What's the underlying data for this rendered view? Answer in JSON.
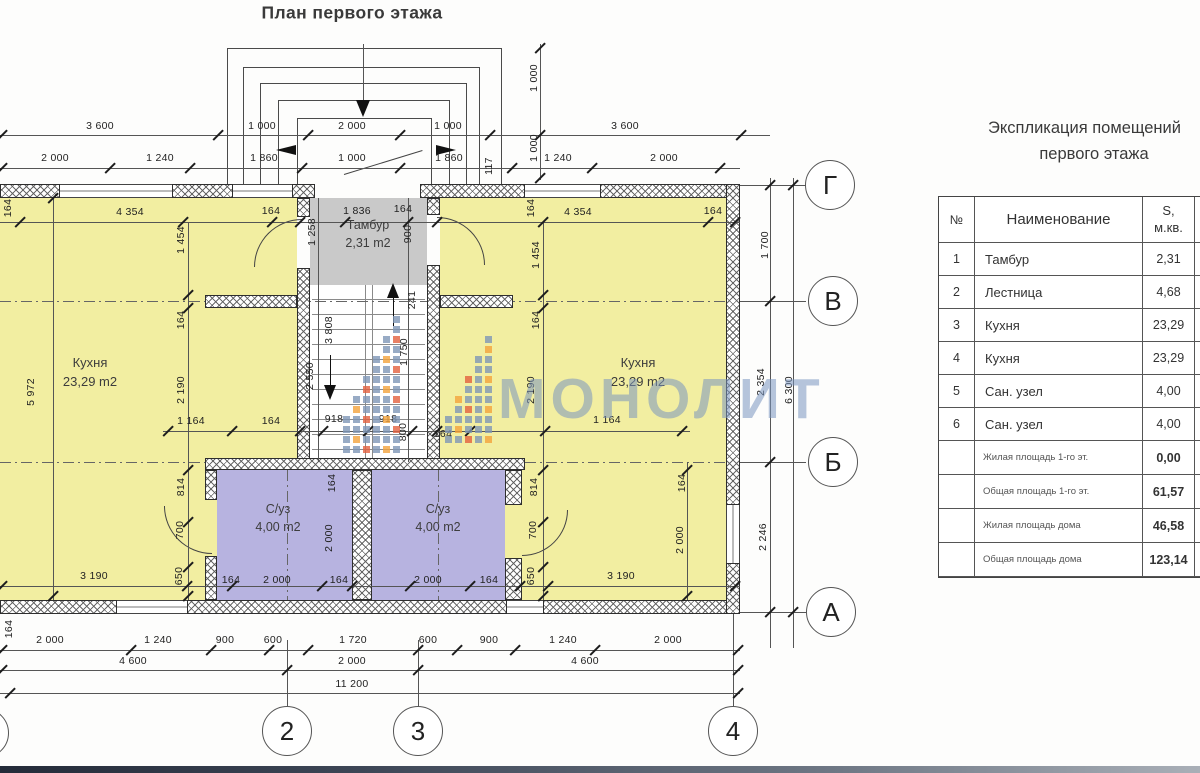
{
  "page": {
    "title": "План первого этажа"
  },
  "watermark": {
    "text": "МОНОЛИТ",
    "text_color": "#7a96c0",
    "logo_colors": {
      "slate": "#7e96b6",
      "orange": "#f2a33c",
      "red": "#e2603e"
    }
  },
  "plan": {
    "colors": {
      "kitchen": "#f2eea1",
      "bath": "#b7b3e0",
      "tambour": "#c9c9c9"
    },
    "rooms": {
      "kitchen_left": {
        "name": "Кухня",
        "area": "23,29 m2"
      },
      "kitchen_right": {
        "name": "Кухня",
        "area": "23,29 m2"
      },
      "tambour": {
        "name": "Тамбур",
        "area": "2,31 m2"
      },
      "bath_left": {
        "name": "С/уз",
        "area": "4,00 m2"
      },
      "bath_right": {
        "name": "С/уз",
        "area": "4,00 m2"
      }
    },
    "dims": [
      [
        "3 600",
        100,
        126,
        0
      ],
      [
        "1 000",
        262,
        126,
        0
      ],
      [
        "2 000",
        352,
        126,
        0
      ],
      [
        "1 000",
        448,
        126,
        0
      ],
      [
        "3 600",
        625,
        126,
        0
      ],
      [
        "2 000",
        55,
        158,
        0
      ],
      [
        "1 240",
        160,
        158,
        0
      ],
      [
        "1 860",
        264,
        158,
        0
      ],
      [
        "1 000",
        352,
        158,
        0
      ],
      [
        "1 860",
        449,
        158,
        0
      ],
      [
        "1 240",
        558,
        158,
        0
      ],
      [
        "2 000",
        664,
        158,
        0
      ],
      [
        "1 000",
        534,
        78,
        1
      ],
      [
        "1 000",
        534,
        148,
        1
      ],
      [
        "117",
        489,
        166,
        1
      ],
      [
        "164",
        8,
        208,
        1
      ],
      [
        "4 354",
        130,
        212,
        0
      ],
      [
        "164",
        271,
        211,
        0
      ],
      [
        "1 836",
        357,
        211,
        0
      ],
      [
        "164",
        403,
        209,
        0
      ],
      [
        "164",
        531,
        208,
        1
      ],
      [
        "4 354",
        578,
        212,
        0
      ],
      [
        "164",
        713,
        211,
        0
      ],
      [
        "1 454",
        181,
        240,
        1
      ],
      [
        "164",
        181,
        320,
        1
      ],
      [
        "2 190",
        181,
        390,
        1
      ],
      [
        "5 972",
        31,
        392,
        1
      ],
      [
        "1 258",
        312,
        232,
        1
      ],
      [
        "900",
        408,
        234,
        1
      ],
      [
        "241",
        412,
        300,
        1
      ],
      [
        "3 808",
        329,
        330,
        1
      ],
      [
        "1 750",
        404,
        352,
        1
      ],
      [
        "2 550",
        310,
        376,
        1
      ],
      [
        "800",
        403,
        432,
        1
      ],
      [
        "918",
        334,
        419,
        0
      ],
      [
        "918",
        388,
        419,
        0
      ],
      [
        "164",
        443,
        434,
        0
      ],
      [
        "1 454",
        536,
        255,
        1
      ],
      [
        "164",
        536,
        320,
        1
      ],
      [
        "2 190",
        531,
        390,
        1
      ],
      [
        "1 164",
        191,
        421,
        0
      ],
      [
        "164",
        271,
        421,
        0
      ],
      [
        "1 164",
        607,
        420,
        0
      ],
      [
        "814",
        181,
        487,
        1
      ],
      [
        "700",
        180,
        530,
        1
      ],
      [
        "650",
        179,
        576,
        1
      ],
      [
        "164",
        332,
        483,
        1
      ],
      [
        "2 000",
        329,
        538,
        1
      ],
      [
        "814",
        534,
        487,
        1
      ],
      [
        "700",
        533,
        530,
        1
      ],
      [
        "650",
        531,
        576,
        1
      ],
      [
        "164",
        682,
        483,
        1
      ],
      [
        "2 000",
        680,
        540,
        1
      ],
      [
        "164",
        231,
        580,
        0
      ],
      [
        "2 000",
        277,
        580,
        0
      ],
      [
        "164",
        339,
        580,
        0
      ],
      [
        "2 000",
        428,
        580,
        0
      ],
      [
        "164",
        489,
        580,
        0
      ],
      [
        "3 190",
        94,
        576,
        0
      ],
      [
        "3 190",
        621,
        576,
        0
      ],
      [
        "164",
        9,
        629,
        1
      ],
      [
        "2 000",
        50,
        640,
        0
      ],
      [
        "1 240",
        158,
        640,
        0
      ],
      [
        "900",
        225,
        640,
        0
      ],
      [
        "600",
        273,
        640,
        0
      ],
      [
        "1 720",
        353,
        640,
        0
      ],
      [
        "600",
        428,
        640,
        0
      ],
      [
        "900",
        489,
        640,
        0
      ],
      [
        "1 240",
        563,
        640,
        0
      ],
      [
        "2 000",
        668,
        640,
        0
      ],
      [
        "4 600",
        133,
        661,
        0
      ],
      [
        "2 000",
        352,
        661,
        0
      ],
      [
        "4 600",
        585,
        661,
        0
      ],
      [
        "11 200",
        352,
        684,
        0
      ],
      [
        "1 700",
        765,
        245,
        1
      ],
      [
        "2 354",
        761,
        382,
        1
      ],
      [
        "6 300",
        789,
        390,
        1
      ],
      [
        "2 246",
        763,
        537,
        1
      ]
    ],
    "ticks": [
      [
        2,
        135
      ],
      [
        218,
        135
      ],
      [
        308,
        135
      ],
      [
        400,
        135
      ],
      [
        490,
        135
      ],
      [
        741,
        135
      ],
      [
        2,
        168
      ],
      [
        110,
        168
      ],
      [
        190,
        168
      ],
      [
        302,
        168
      ],
      [
        400,
        168
      ],
      [
        512,
        168
      ],
      [
        592,
        168
      ],
      [
        720,
        168
      ],
      [
        20,
        222
      ],
      [
        183,
        222
      ],
      [
        272,
        222
      ],
      [
        300,
        222
      ],
      [
        345,
        222
      ],
      [
        408,
        222
      ],
      [
        437,
        222
      ],
      [
        543,
        222
      ],
      [
        708,
        222
      ],
      [
        735,
        222
      ],
      [
        168,
        431
      ],
      [
        232,
        431
      ],
      [
        300,
        431
      ],
      [
        323,
        431
      ],
      [
        368,
        431
      ],
      [
        412,
        431
      ],
      [
        437,
        431
      ],
      [
        470,
        431
      ],
      [
        545,
        431
      ],
      [
        682,
        431
      ],
      [
        2,
        586
      ],
      [
        187,
        586
      ],
      [
        232,
        586
      ],
      [
        322,
        586
      ],
      [
        352,
        586
      ],
      [
        410,
        586
      ],
      [
        470,
        586
      ],
      [
        520,
        586
      ],
      [
        548,
        586
      ],
      [
        735,
        586
      ],
      [
        2,
        650
      ],
      [
        131,
        650
      ],
      [
        211,
        650
      ],
      [
        269,
        650
      ],
      [
        308,
        650
      ],
      [
        418,
        650
      ],
      [
        457,
        650
      ],
      [
        515,
        650
      ],
      [
        595,
        650
      ],
      [
        738,
        650
      ],
      [
        2,
        670
      ],
      [
        287,
        670
      ],
      [
        418,
        670
      ],
      [
        738,
        670
      ],
      [
        10,
        693
      ],
      [
        738,
        693
      ],
      [
        188,
        295
      ],
      [
        188,
        308
      ],
      [
        188,
        470
      ],
      [
        188,
        522
      ],
      [
        188,
        567
      ],
      [
        188,
        596
      ],
      [
        543,
        295
      ],
      [
        543,
        308
      ],
      [
        543,
        470
      ],
      [
        543,
        522
      ],
      [
        543,
        567
      ],
      [
        543,
        596
      ],
      [
        540,
        48
      ],
      [
        540,
        135
      ],
      [
        540,
        178
      ],
      [
        770,
        185
      ],
      [
        770,
        301
      ],
      [
        770,
        462
      ],
      [
        770,
        612
      ],
      [
        793,
        185
      ],
      [
        793,
        612
      ],
      [
        53,
        198
      ],
      [
        53,
        596
      ],
      [
        687,
        470
      ],
      [
        687,
        596
      ]
    ],
    "axis_circles": [
      {
        "label": "Г",
        "x": 830,
        "y": 185
      },
      {
        "label": "В",
        "x": 833,
        "y": 301
      },
      {
        "label": "Б",
        "x": 833,
        "y": 462
      },
      {
        "label": "А",
        "x": 831,
        "y": 612
      },
      {
        "label": "2",
        "x": 287,
        "y": 731
      },
      {
        "label": "3",
        "x": 418,
        "y": 731
      },
      {
        "label": "4",
        "x": 733,
        "y": 731
      },
      {
        "label": "",
        "x": -16,
        "y": 733
      }
    ]
  },
  "table": {
    "title_line1": "Экспликация помещений",
    "title_line2": "первого этажа",
    "headers": {
      "num": "№",
      "name": "Наименование",
      "area1": "S,",
      "area2": "м.кв."
    },
    "rows": [
      {
        "num": "1",
        "name": "Тамбур",
        "area": "2,31"
      },
      {
        "num": "2",
        "name": "Лестница",
        "area": "4,68"
      },
      {
        "num": "3",
        "name": "Кухня",
        "area": "23,29"
      },
      {
        "num": "4",
        "name": "Кухня",
        "area": "23,29"
      },
      {
        "num": "5",
        "name": "Сан. узел",
        "area": "4,00"
      },
      {
        "num": "6",
        "name": "Сан. узел",
        "area": "4,00"
      }
    ],
    "summary": [
      {
        "name": "Жилая площадь 1-го эт.",
        "value": "0,00"
      },
      {
        "name": "Общая площадь 1-го эт.",
        "value": "61,57"
      },
      {
        "name": "Жилая площадь дома",
        "value": "46,58"
      },
      {
        "name": "Общая площадь дома",
        "value": "123,14"
      }
    ]
  }
}
